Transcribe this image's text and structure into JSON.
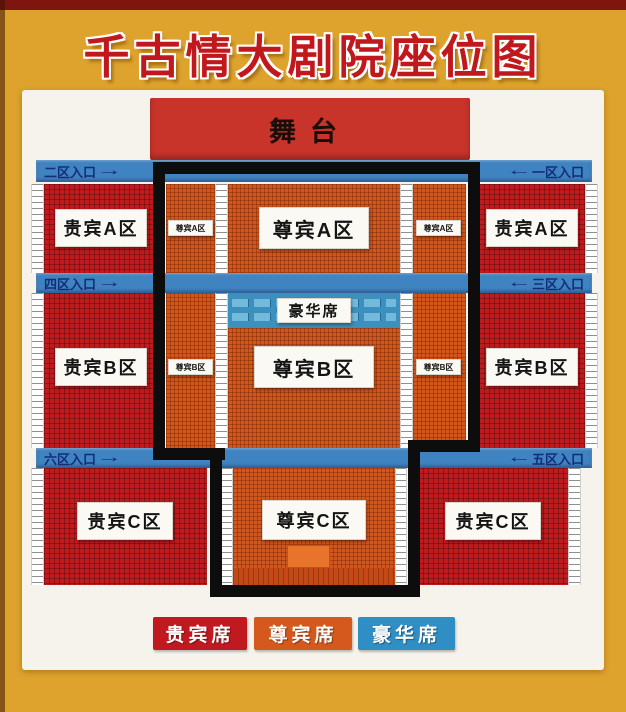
{
  "page_title": "千古情大剧院座位图",
  "stage_label": "舞台",
  "entrances": {
    "zone2": {
      "label": "二区入口",
      "arrow": "→"
    },
    "zone1": {
      "label": "一区入口",
      "arrow": "←"
    },
    "zone4": {
      "label": "四区入口",
      "arrow": "→"
    },
    "zone3": {
      "label": "三区入口",
      "arrow": "←"
    },
    "zone6": {
      "label": "六区入口",
      "arrow": "→"
    },
    "zone5": {
      "label": "五区入口",
      "arrow": "←"
    }
  },
  "sections": {
    "vip_a_left": "贵宾A区",
    "vip_a_right": "贵宾A区",
    "premium_a_left": "尊宾A区",
    "premium_a_center": "尊宾A区",
    "premium_a_right": "尊宾A区",
    "deluxe": "豪华席",
    "vip_b_left": "贵宾B区",
    "vip_b_right": "贵宾B区",
    "premium_b_left": "尊宾B区",
    "premium_b_center": "尊宾B区",
    "premium_b_right": "尊宾B区",
    "vip_c_left": "贵宾C区",
    "vip_c_right": "贵宾C区",
    "premium_c_center": "尊宾C区"
  },
  "legend": {
    "vip": {
      "label": "贵宾席",
      "color": "#c01a20"
    },
    "premium": {
      "label": "尊宾席",
      "color": "#d5591c"
    },
    "deluxe": {
      "label": "豪华席",
      "color": "#2f8fc5"
    }
  },
  "colors": {
    "background_gold": "#dda32c",
    "top_bar_maroon": "#7e150f",
    "title_red": "#c0181c",
    "stage_red": "#c9342a",
    "vip_seat_red": "#be1b1f",
    "premium_seat_orange": "#d1571d",
    "deluxe_seat_blue": "#3b90be",
    "aisle_blue": "#3f83c0",
    "entrance_text_navy": "#142d78",
    "outline_black": "#0d0d0d"
  }
}
